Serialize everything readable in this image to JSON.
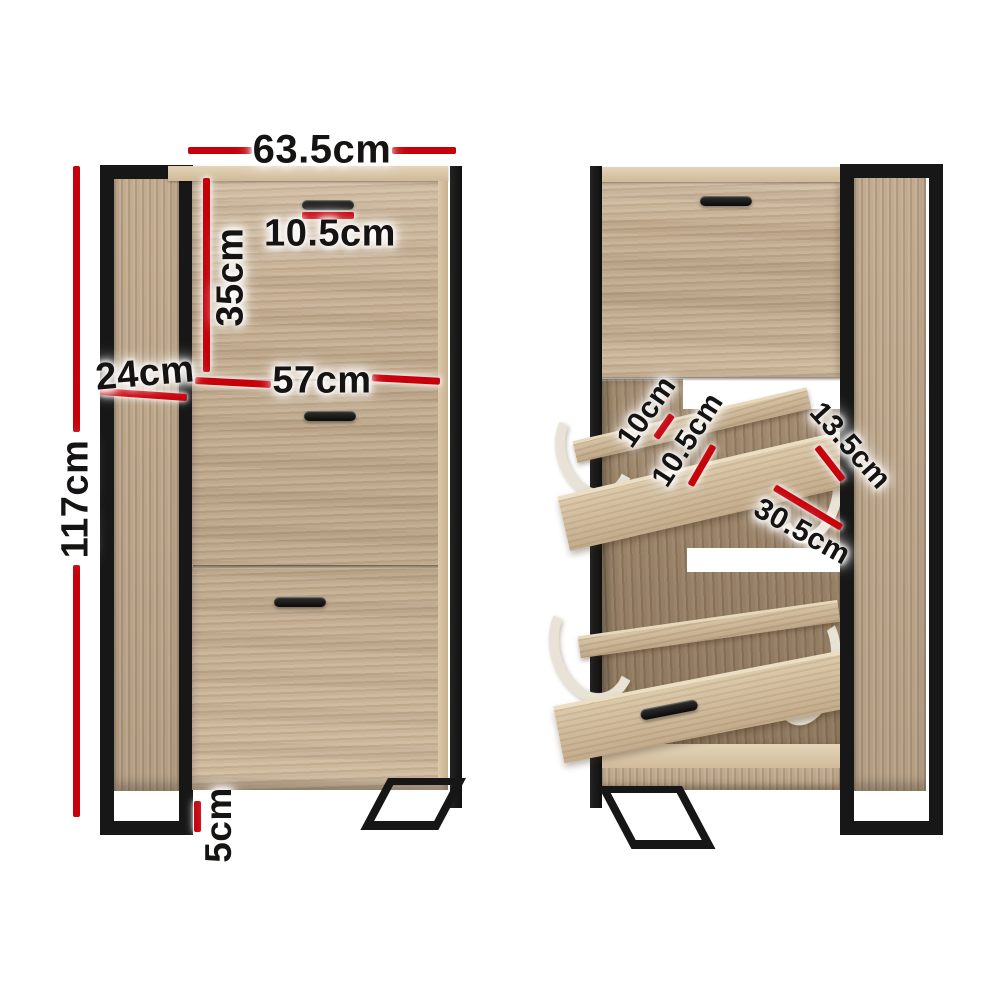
{
  "image_type": "product-dimension-diagram",
  "colors": {
    "dimension_red": "#c7000a",
    "metal_black": "#171717",
    "wood_light": "#d7c4a5",
    "wood_mid": "#cbb496",
    "wood_side": "#b89f84",
    "wood_interior": "#95805f",
    "bracket_white": "#e9e3d7",
    "background": "#ffffff"
  },
  "dimensions": {
    "overall_width": "63.5cm",
    "handle_width": "10.5cm",
    "top_door_height": "35cm",
    "depth": "24cm",
    "inner_width": "57cm",
    "overall_height": "117cm",
    "leg_height": "5cm",
    "shelf_gap": "10cm",
    "divider_gap": "10.5cm",
    "flap_depth": "13.5cm",
    "flap_width": "30.5cm"
  }
}
